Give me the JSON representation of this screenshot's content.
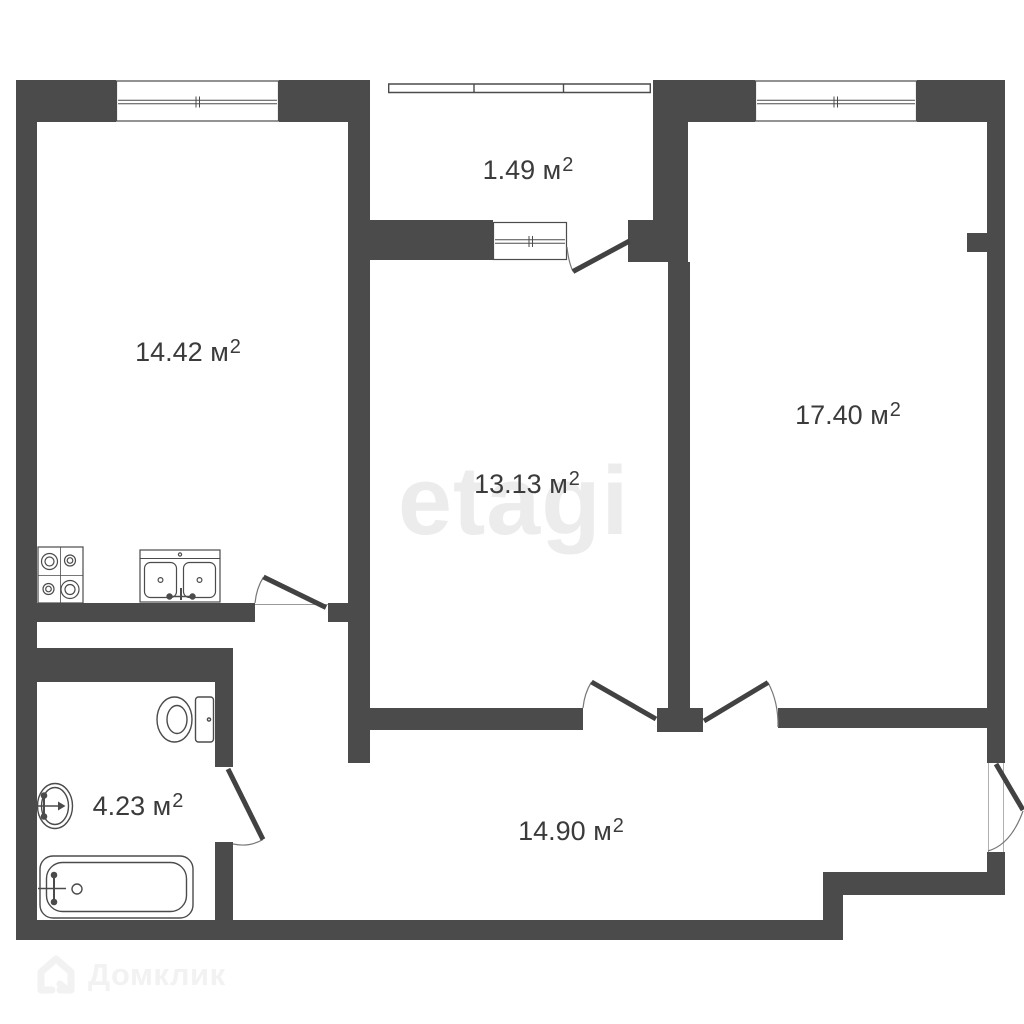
{
  "plan": {
    "rooms": [
      {
        "key": "kitchen-living",
        "area": "14.42 м",
        "sup": "2"
      },
      {
        "key": "balcony",
        "area": "1.49 м",
        "sup": "2"
      },
      {
        "key": "bedroom-1",
        "area": "13.13 м",
        "sup": "2"
      },
      {
        "key": "bedroom-2",
        "area": "17.40 м",
        "sup": "2"
      },
      {
        "key": "bathroom",
        "area": "4.23 м",
        "sup": "2"
      },
      {
        "key": "hallway",
        "area": "14.90 м",
        "sup": "2"
      }
    ]
  },
  "watermarks": {
    "center": "etagi",
    "brand": "Домклик"
  },
  "colors": {
    "wall": "#4b4b4b",
    "label_text": "#3b3b3b",
    "watermark_center": "#ececec",
    "watermark_brand": "#f2f2f2",
    "background": "#ffffff"
  }
}
